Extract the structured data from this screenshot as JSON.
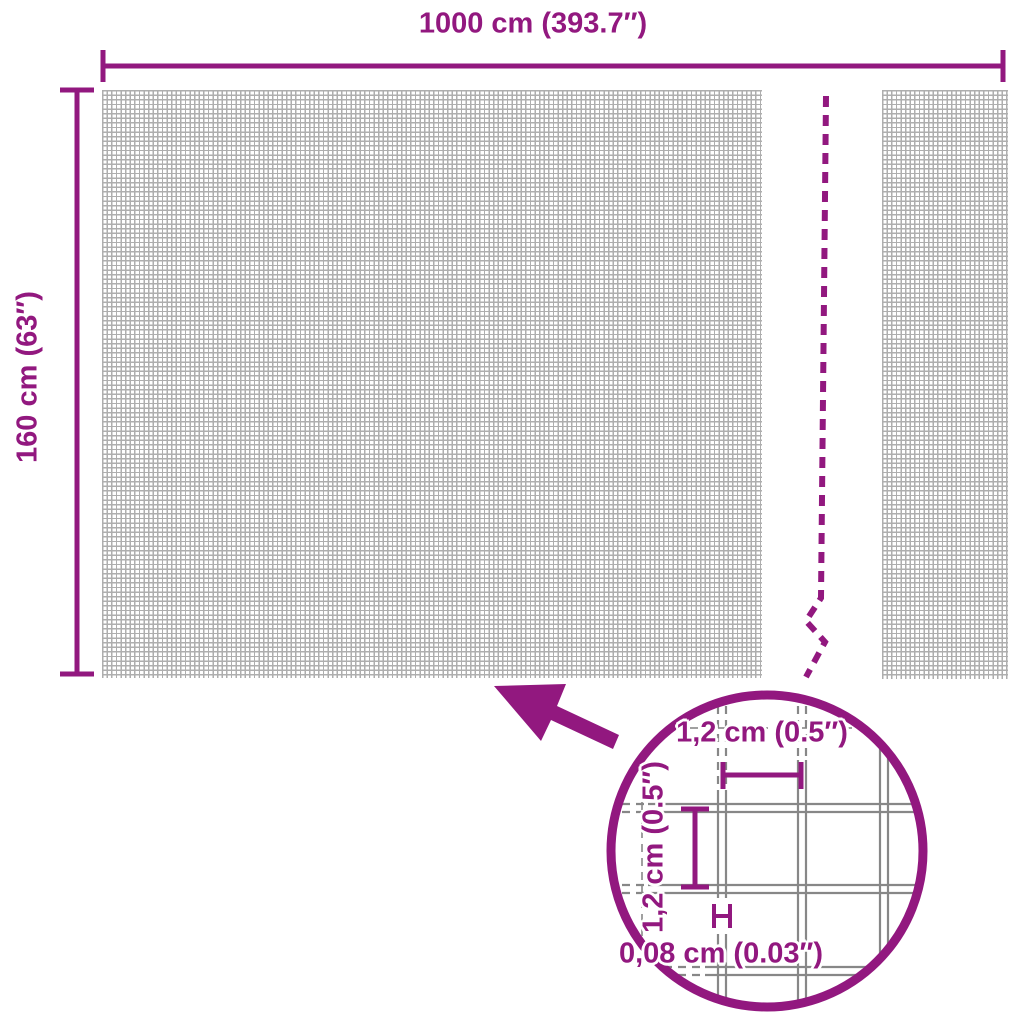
{
  "diagram": {
    "top_dimension": {
      "label": "1000 cm (393.7″)"
    },
    "left_dimension": {
      "label": "160 cm (63″)"
    },
    "detail": {
      "horizontal_dimension": {
        "label": "1,2 cm (0.5″)"
      },
      "vertical_dimension": {
        "label": "1,2 cm (0.5″)"
      },
      "thickness_dimension": {
        "label": "0,08 cm (0.03″)"
      }
    }
  },
  "icons": {
    "zoom_arrow": "arrow-pointing-up-left",
    "magnifier": "zoom-detail-circle",
    "break_line": "dashed-break-line"
  },
  "colors": {
    "accent": "#92187F",
    "mesh_grid": "#AEAEAE",
    "wire": "#878787",
    "wire_guide": "#A0A0A0",
    "background": "#FFFFFF"
  }
}
